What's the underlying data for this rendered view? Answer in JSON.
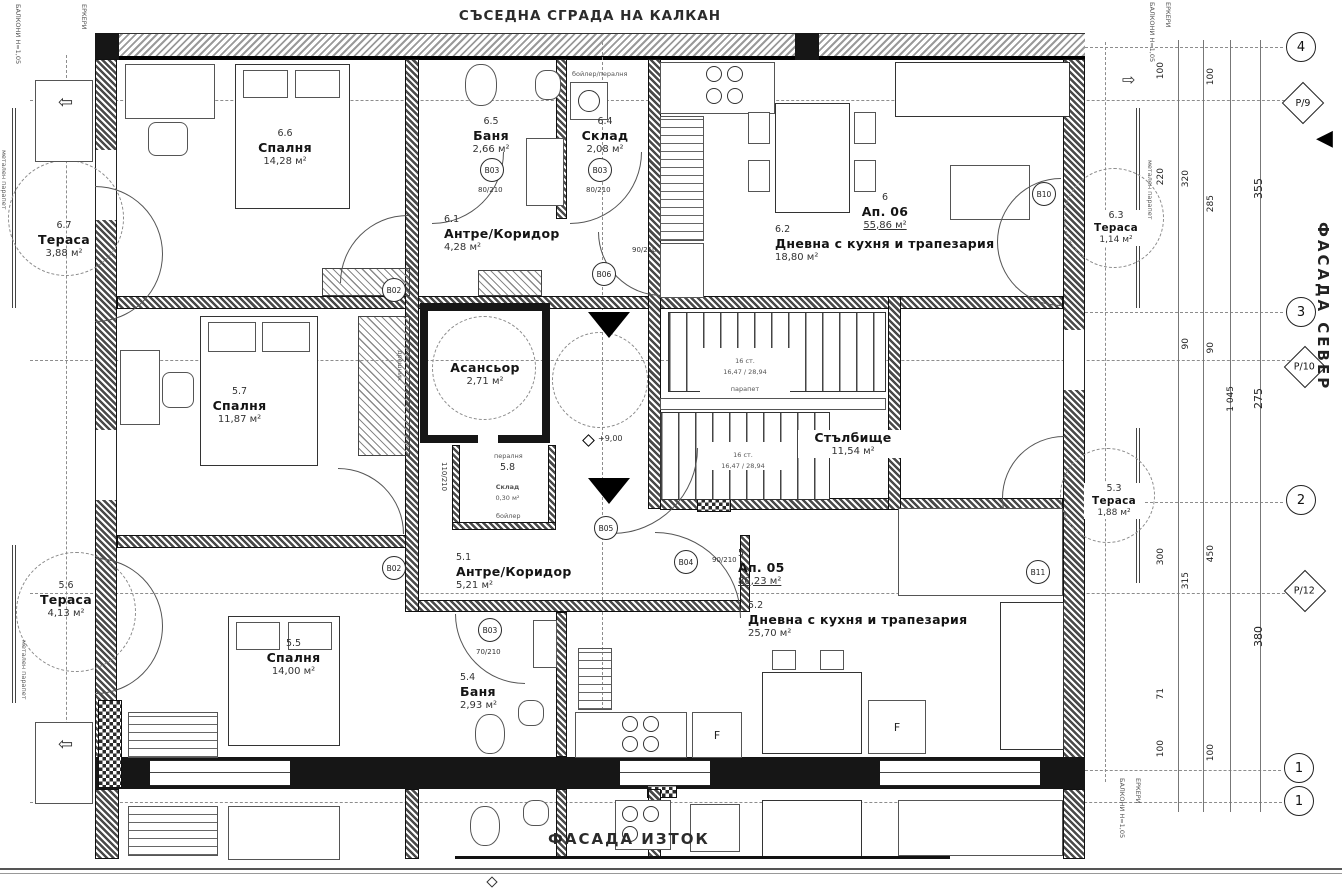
{
  "titles": {
    "neighbor": "СЪСЕДНА СГРАДА НА КАЛКАН",
    "facade_north": "ФАСАДА СЕВЕР",
    "facade_east": "ФАСАДА ИЗТОК"
  },
  "rooms": {
    "r66": {
      "n": "6.6",
      "t": "Спалня",
      "a": "14,28 м²"
    },
    "r65": {
      "n": "6.5",
      "t": "Баня",
      "a": "2,66 м²"
    },
    "r64": {
      "n": "6.4",
      "t": "Склад",
      "a": "2,08 м²"
    },
    "r61": {
      "n": "6.1",
      "t": "Антре/Коридор",
      "a": "4,28 м²"
    },
    "ap06": {
      "n": "6",
      "t": "Ап. 06",
      "a": "55,86 м²"
    },
    "r62": {
      "n": "6.2",
      "t": "Дневна с кухня и трапезария",
      "a": "18,80 м²"
    },
    "r67": {
      "n": "6.7",
      "t": "Тераса",
      "a": "3,88 м²"
    },
    "r63": {
      "n": "6.3",
      "t": "Тераса",
      "a": "1,14 м²"
    },
    "lift": {
      "t": "Асансьор",
      "a": "2,71 м²"
    },
    "stairs": {
      "t": "Стълбище",
      "a": "11,54 м²"
    },
    "r58": {
      "n": "5.8",
      "t": "Склад",
      "a": "0,30 м²"
    },
    "r57": {
      "n": "5.7",
      "t": "Спалня",
      "a": "11,87 м²"
    },
    "r51": {
      "n": "5.1",
      "t": "Антре/Коридор",
      "a": "5,21 м²"
    },
    "ap05": {
      "n": "5",
      "t": "Ап. 05",
      "a": "80,23 м²"
    },
    "r52": {
      "n": "5.2",
      "t": "Дневна с кухня и трапезария",
      "a": "25,70 м²"
    },
    "r55": {
      "n": "5.5",
      "t": "Спалня",
      "a": "14,00 м²"
    },
    "r54": {
      "n": "5.4",
      "t": "Баня",
      "a": "2,93 м²"
    },
    "r56": {
      "n": "5.6",
      "t": "Тераса",
      "a": "4,13 м²"
    },
    "r53": {
      "n": "5.3",
      "t": "Тераса",
      "a": "1,88 м²"
    }
  },
  "door_tags": {
    "b02a": "B02",
    "b02b": "B02",
    "b03a": "B03",
    "b03b": "B03",
    "b03c": "B03",
    "b04": "B04",
    "b05": "B05",
    "b06": "B06",
    "b10": "B10",
    "b11": "B11"
  },
  "door_sizes": {
    "s90": "90/210",
    "s80": "80/210",
    "s70": "70/210",
    "s110": "110/210"
  },
  "grid": {
    "c4": "4",
    "c3": "3",
    "c2": "2",
    "c1": "1",
    "c1b": "1",
    "p9": "Р/9",
    "p10": "Р/10",
    "p12": "Р/12"
  },
  "dims": {
    "t100a": "100",
    "t100b": "100",
    "d220": "220",
    "d320": "320",
    "d285": "285",
    "d355": "355",
    "d90a": "90",
    "d90b": "90",
    "d275": "275",
    "d1045": "1 045",
    "d300": "300",
    "d315": "315",
    "d450": "450",
    "d380": "380",
    "d71": "71",
    "b100a": "100",
    "b100b": "100"
  },
  "ann": {
    "level": "+9,00",
    "steps1": "16 ст.",
    "riser1": "16,47 / 28,94",
    "steps2": "16 ст.",
    "riser2": "16,47 / 28,94",
    "parapet": "парапет",
    "peralnya": "пералня",
    "boiler": "бойлер",
    "boiler_peralnya": "бойлер/пералня",
    "fridge1": "F",
    "fridge2": "F",
    "metal1": "метален парапет",
    "metal2": "метален парапет",
    "metal3": "метален парапет",
    "balkoni": "БАЛКОНИ Н=1,05",
    "erkeri": "ЕРКЕРИ",
    "dreshnik": "дрешник"
  }
}
